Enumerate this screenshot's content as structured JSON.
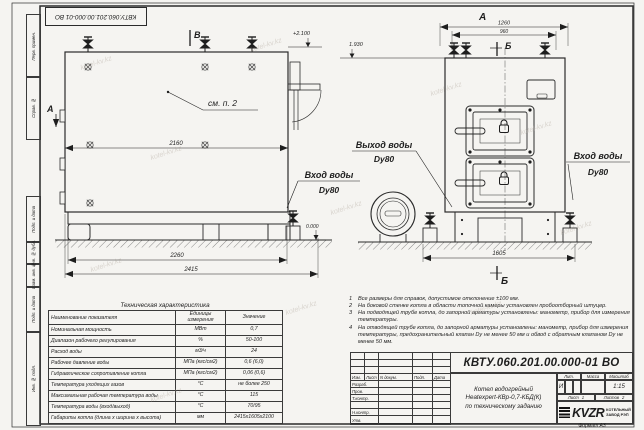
{
  "sheet": {
    "doc_number": "КВТУ.060.201.00.000-01 ВО",
    "format_label": "Формат  А3",
    "watermark": "kotel-kv.kz"
  },
  "margin": {
    "top_cells": [
      "Перв. примен.",
      "Справ. №"
    ],
    "bottom_cells": [
      "Подп. и дата",
      "Инв. № дубл.",
      "Взам. инв. №",
      "Подп. и дата",
      "Инв. № подл."
    ]
  },
  "drawing": {
    "markers": {
      "top_section": "В",
      "side_view": "А",
      "front_view": "А",
      "front_section_top": "Б",
      "front_section_bottom": "Б"
    },
    "labels": {
      "see_note": "см. п. 2",
      "outlet": "Выход воды",
      "outlet_dn": "Dy80",
      "inlet_mid": "Вход воды",
      "inlet_mid_dn": "Dy80",
      "inlet_right": "Вход воды",
      "inlet_right_dn": "Dy80"
    },
    "elevations": {
      "top": "+2.100",
      "shed": "1.930",
      "zero": "0.000"
    },
    "dims": {
      "side_top": "2160",
      "side_base": "2260",
      "side_total": "2415",
      "front_total": "1260",
      "front_top": "960",
      "front_base": "1605"
    }
  },
  "tech_table": {
    "title": "Техническая характеристика",
    "headers": [
      "Наименование показателя",
      "Единицы измерения",
      "Значение"
    ],
    "rows": [
      [
        "Номинальная мощность",
        "МВт",
        "0,7"
      ],
      [
        "Диапазон рабочего регулирования",
        "%",
        "50-100"
      ],
      [
        "Расход воды",
        "м3/ч",
        "24"
      ],
      [
        "Рабочее давление воды",
        "МПа (кгс/см2)",
        "0,6 (6,0)"
      ],
      [
        "Гидравлическое сопротивление котла",
        "МПа (кгс/см2)",
        "0,06 (0,6)"
      ],
      [
        "Температура уходящих газов",
        "°С",
        "не более 250"
      ],
      [
        "Максимальная рабочая температура воды",
        "°С",
        "115"
      ],
      [
        "Температура воды (вход/выход)",
        "°С",
        "70/95"
      ],
      [
        "Габариты котла (длина х ширина х высота)",
        "мм",
        "2415х1605х2100"
      ]
    ]
  },
  "notes": {
    "items": [
      {
        "n": "1",
        "text": "Все размеры для справок, допустимое отклонение ±100 мм."
      },
      {
        "n": "2",
        "text": "На боковой стенке котла в области топочной камеры установлен пробоотборный штуцер."
      },
      {
        "n": "3",
        "text": "На подводящей трубе котла, до запорной арматуры установлены: манометр, прибор для измерения температуры."
      },
      {
        "n": "4",
        "text": "На отводящей трубе котла, до запорной арматуры установлены: манометр, прибор для измерения температуры, предохранительный клапан Dy не менее 50 мм и обвод с обратным клапаном Dy не менее 50 мм."
      }
    ]
  },
  "title_block": {
    "doc_number": "КВТУ.060.201.00.000-01  ВО",
    "header_cols": [
      "Изм.",
      "Лист",
      "N докум.",
      "Подп.",
      "Дата"
    ],
    "row_labels": [
      "Разраб.",
      "Пров.",
      "Т.контр.",
      "Н.контр.",
      "Утв."
    ],
    "name_lines": [
      "Котел водогрейный",
      "Heatexpert-КВр-0,7-КБД(К)",
      "по техническому заданию"
    ],
    "lit_label": "Лит.",
    "lit_value": "И",
    "mass_label": "Масса",
    "scale_label": "Масштаб",
    "scale_value": "1:15",
    "sheet_label": "Лист",
    "sheet_value": "1",
    "sheets_label": "Листов",
    "sheets_value": "2",
    "logo_text": "KVZR",
    "logo_caption": [
      "КОТЕЛЬНЫЙ",
      "ЗАВОД РЭП"
    ]
  }
}
